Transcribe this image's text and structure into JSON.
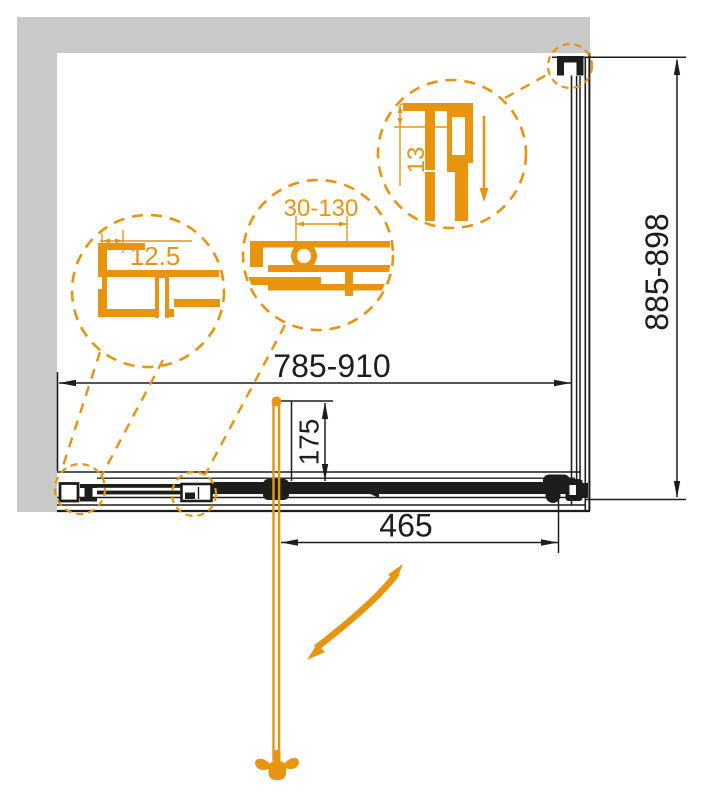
{
  "drawing": {
    "type": "shower-enclosure-plan-technical-drawing",
    "dimensions": {
      "width_range": "785-910",
      "height_range": "885-898",
      "door_opening": "465",
      "handle_offset": "175"
    },
    "details": {
      "wall_profile": "12.5",
      "adjustment": "30-130",
      "top_profile": "13"
    },
    "colors": {
      "accent_orange": "#E8940F",
      "line_black": "#1D1D1B",
      "wall_gray": "#C9C9C9"
    }
  }
}
